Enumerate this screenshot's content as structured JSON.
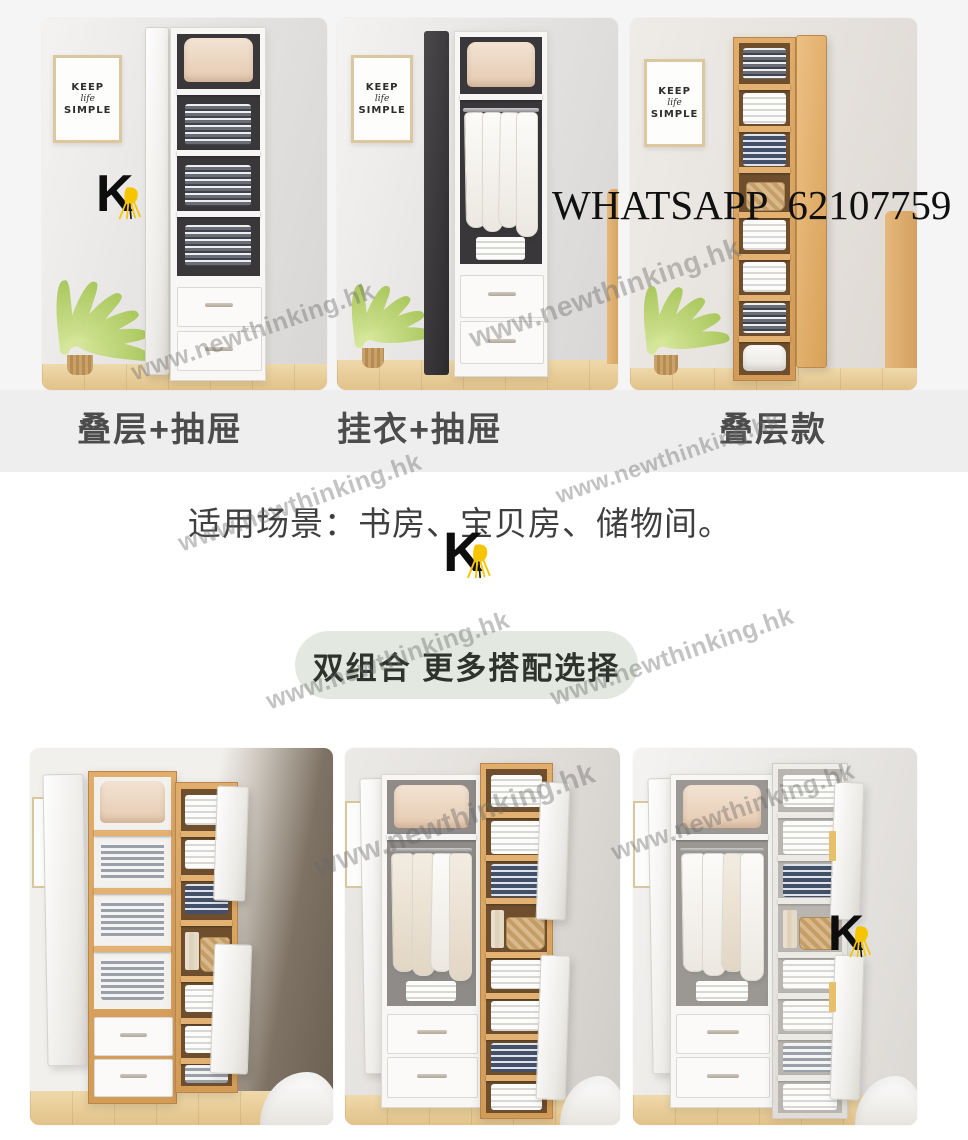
{
  "overlay": {
    "whatsapp": "WHATSAPP  62107759",
    "watermark": "www.newthinking.hk"
  },
  "brand": {
    "letter": "K"
  },
  "poster": {
    "line1": "KEEP",
    "line2": "life",
    "line3": "SIMPLE"
  },
  "gallery_top": {
    "labels": [
      "叠层+抽屉",
      "挂衣+抽屉",
      "叠层款"
    ]
  },
  "middle": {
    "caption": "适用场景：书房、宝贝房、储物间。",
    "badge": "双组合 更多搭配选择"
  },
  "colors": {
    "accent_yellow": "#F6C500",
    "badge_bg": "#E3E9E0",
    "label_text": "#4C4C4C",
    "band_bg": "#EEEEEF"
  }
}
